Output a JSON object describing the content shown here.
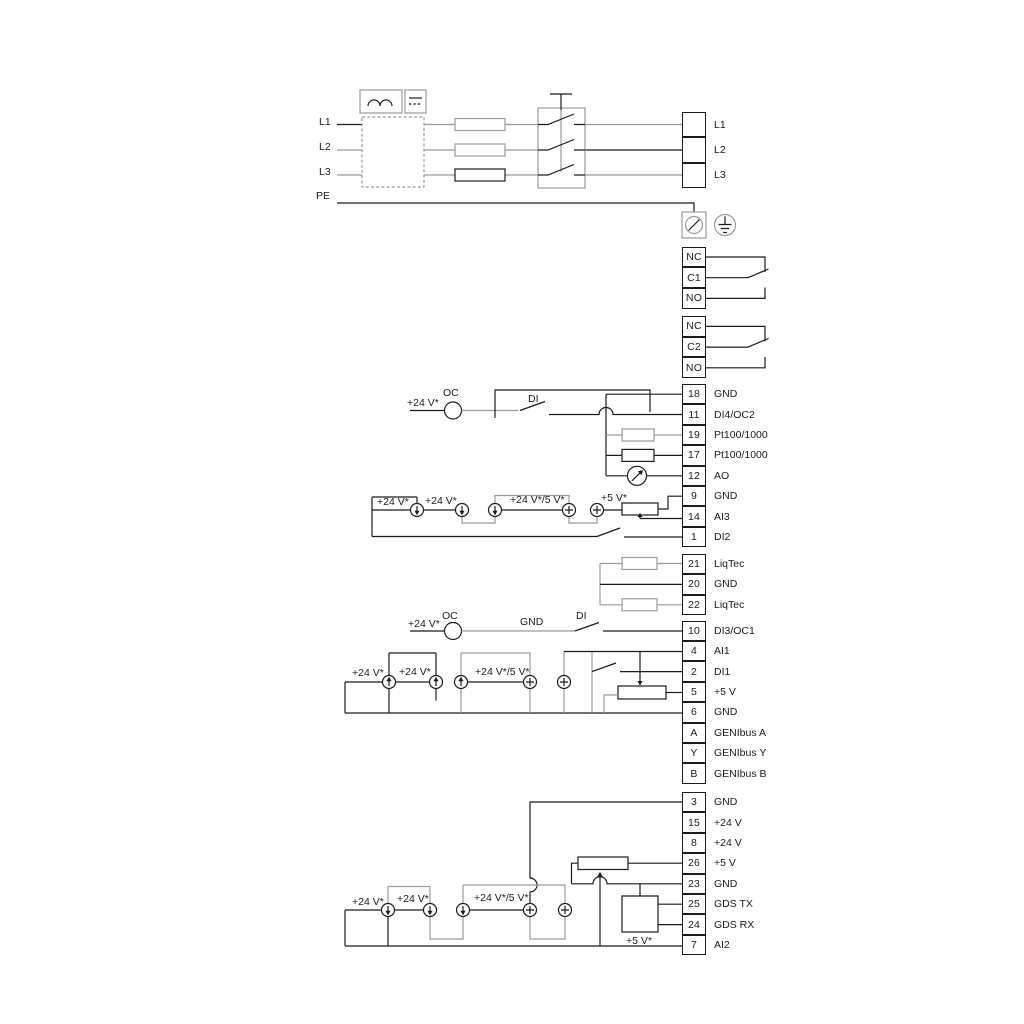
{
  "diagram": {
    "kind": "pump drive wiring diagram",
    "sections": [
      "mains power input",
      "signal relays",
      "control terminals",
      "GENIbus",
      "sensor supply / GDS"
    ]
  },
  "colors": {
    "wire_dark": "#1c1c1c",
    "wire_gray": "#9b9b9b",
    "background": "#ffffff"
  },
  "symbols": {
    "ac-symbol": "double sine humps (AC)",
    "dc-symbol": "solid line over dashed line (DC)",
    "emc-filter-box": "dashed rectangle",
    "fuse-icon": "rectangle on wire",
    "main-switch-icon": "3-pole blade switch with handle",
    "screw-terminal-icon": "boxed circle with slash",
    "earth-ground-icon": "circle with grounding bars",
    "current-source-icon": "circle with arrow",
    "current-source-plus-icon": "circle with plus",
    "oc-circle-icon": "open collector circle",
    "meter-icon": "circle with pointer needle (analog output)",
    "resistor-icon": "rectangle on wire",
    "potentiometer-icon": "rectangle with wiper arrow",
    "switch-blade-icon": "open contact blade",
    "relay-contact-icon": "changeover contact"
  },
  "terminal_groups": [
    {
      "name": "mains-output",
      "x": 682,
      "y": 112,
      "cell_w": 24,
      "cell_h": 25.3,
      "label_x": 714,
      "rows": [
        {
          "id": "",
          "label": "L1"
        },
        {
          "id": "",
          "label": "L2"
        },
        {
          "id": "",
          "label": "L3"
        }
      ]
    },
    {
      "name": "relay-1",
      "x": 682,
      "y": 246.6,
      "cell_w": 24,
      "cell_h": 20.7,
      "label_x": 714,
      "rows": [
        {
          "id": "NC",
          "label": ""
        },
        {
          "id": "C1",
          "label": ""
        },
        {
          "id": "NO",
          "label": ""
        }
      ]
    },
    {
      "name": "relay-2",
      "x": 682,
      "y": 316,
      "cell_w": 24,
      "cell_h": 20.7,
      "label_x": 714,
      "rows": [
        {
          "id": "NC",
          "label": ""
        },
        {
          "id": "C2",
          "label": ""
        },
        {
          "id": "NO",
          "label": ""
        }
      ]
    },
    {
      "name": "io-block-1",
      "x": 682,
      "y": 384,
      "cell_w": 24,
      "cell_h": 20.4,
      "label_x": 714,
      "rows": [
        {
          "id": "18",
          "label": "GND"
        },
        {
          "id": "11",
          "label": "DI4/OC2"
        },
        {
          "id": "19",
          "label": "Pt100/1000"
        },
        {
          "id": "17",
          "label": "Pt100/1000"
        },
        {
          "id": "12",
          "label": "AO"
        },
        {
          "id": "9",
          "label": "GND"
        },
        {
          "id": "14",
          "label": "AI3"
        },
        {
          "id": "1",
          "label": "DI2"
        }
      ]
    },
    {
      "name": "liqtec-block",
      "x": 682,
      "y": 553.8,
      "cell_w": 24,
      "cell_h": 20.4,
      "label_x": 714,
      "rows": [
        {
          "id": "21",
          "label": "LiqTec"
        },
        {
          "id": "20",
          "label": "GND"
        },
        {
          "id": "22",
          "label": "LiqTec"
        }
      ]
    },
    {
      "name": "io-block-2",
      "x": 682,
      "y": 620.6,
      "cell_w": 24,
      "cell_h": 20.4,
      "label_x": 714,
      "rows": [
        {
          "id": "10",
          "label": "DI3/OC1"
        },
        {
          "id": "4",
          "label": "AI1"
        },
        {
          "id": "2",
          "label": "DI1"
        },
        {
          "id": "5",
          "label": "+5 V"
        },
        {
          "id": "6",
          "label": "GND"
        },
        {
          "id": "A",
          "label": "GENIbus A"
        },
        {
          "id": "Y",
          "label": "GENIbus Y"
        },
        {
          "id": "B",
          "label": "GENIbus B"
        }
      ]
    },
    {
      "name": "io-block-3",
      "x": 682,
      "y": 792,
      "cell_w": 24,
      "cell_h": 20.4,
      "label_x": 714,
      "rows": [
        {
          "id": "3",
          "label": "GND"
        },
        {
          "id": "15",
          "label": "+24 V"
        },
        {
          "id": "8",
          "label": "+24 V"
        },
        {
          "id": "26",
          "label": "+5 V"
        },
        {
          "id": "23",
          "label": "GND"
        },
        {
          "id": "25",
          "label": "GDS TX"
        },
        {
          "id": "24",
          "label": "GDS RX"
        },
        {
          "id": "7",
          "label": "AI2"
        }
      ]
    }
  ],
  "floating_labels": [
    {
      "text": "L1",
      "x": 319,
      "y": 116
    },
    {
      "text": "L2",
      "x": 319,
      "y": 141
    },
    {
      "text": "L3",
      "x": 319,
      "y": 166
    },
    {
      "text": "PE",
      "x": 316,
      "y": 190
    },
    {
      "text": "+24 V*",
      "x": 407,
      "y": 397
    },
    {
      "text": "OC",
      "x": 443,
      "y": 387
    },
    {
      "text": "DI",
      "x": 528,
      "y": 393
    },
    {
      "text": "+24 V*",
      "x": 377,
      "y": 496
    },
    {
      "text": "+24 V*",
      "x": 425,
      "y": 495
    },
    {
      "text": "+24 V*/5 V*",
      "x": 510,
      "y": 494
    },
    {
      "text": "+5 V*",
      "x": 601,
      "y": 492
    },
    {
      "text": "+24 V*",
      "x": 408,
      "y": 618
    },
    {
      "text": "OC",
      "x": 442,
      "y": 610
    },
    {
      "text": "GND",
      "x": 520,
      "y": 616
    },
    {
      "text": "DI",
      "x": 576,
      "y": 610
    },
    {
      "text": "+24 V*",
      "x": 352,
      "y": 667
    },
    {
      "text": "+24 V*",
      "x": 399,
      "y": 666
    },
    {
      "text": "+24 V*/5 V*",
      "x": 475,
      "y": 666
    },
    {
      "text": "+24 V*",
      "x": 352,
      "y": 896
    },
    {
      "text": "+24 V*",
      "x": 397,
      "y": 893
    },
    {
      "text": "+24 V*/5 V*",
      "x": 474,
      "y": 892
    },
    {
      "text": "+5 V*",
      "x": 626,
      "y": 935
    }
  ]
}
